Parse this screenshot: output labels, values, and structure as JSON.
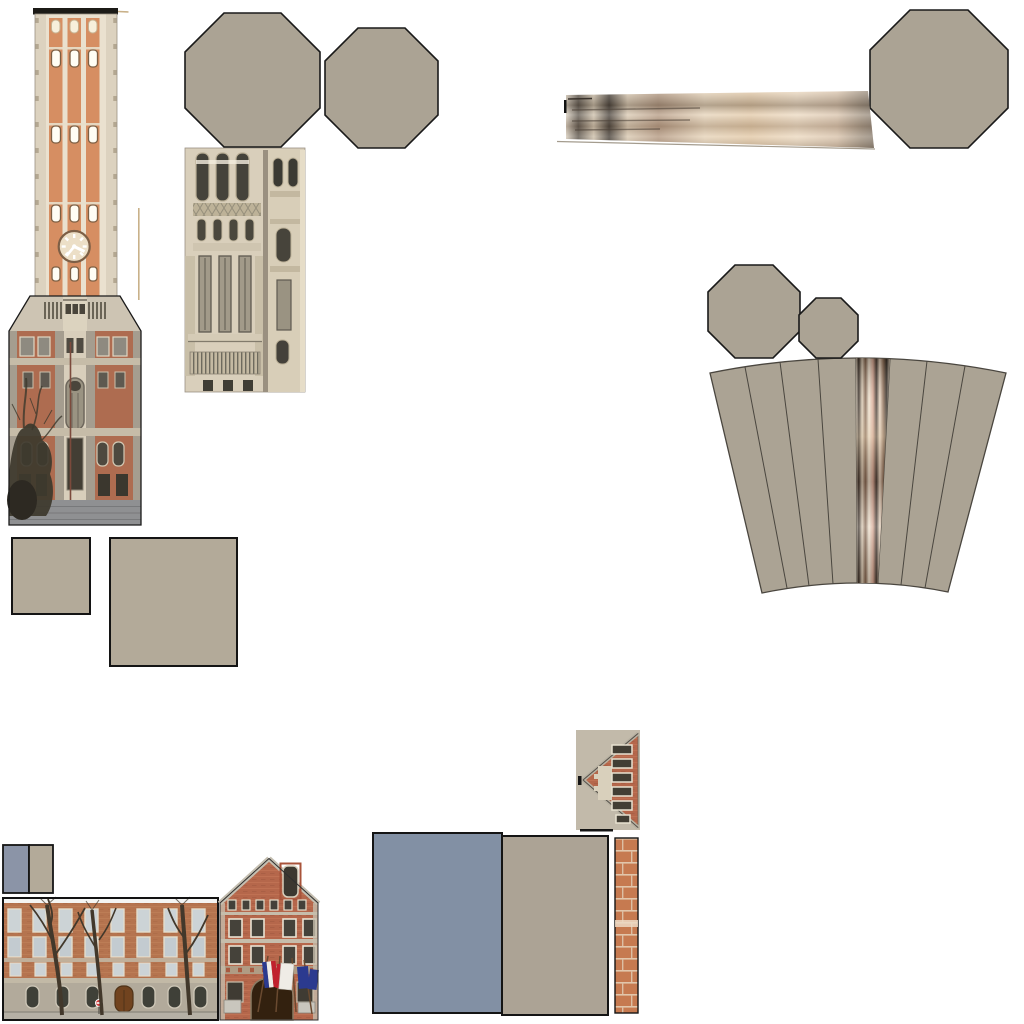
{
  "page": {
    "background": "#ffffff",
    "kind": "texture-atlas-sheet",
    "subject": "unwrapped photo textures and flat roof/wall color patches for 3D building models (belfry tower, school facades, octagonal roof caps, cone roof fan)"
  },
  "palette": {
    "outline": "#1a1a1a",
    "taupe": "#aba394",
    "taupe_light": "#c2baaa",
    "taupe_square": "#b3aa99",
    "taupe_rect": "#aca395",
    "slate_blue": "#8290a4",
    "slate_blue_small": "#8b94a7",
    "tower_cream": "#eae1cf",
    "tower_side_stone": "#dcd2bf",
    "tower_orange": "#d68e62",
    "tower_cap": "#1c1b17",
    "tan_line": "#c9b189",
    "trapezoid_stone": "#cdc4b3",
    "base_fill": "#b3a794",
    "base_brick": "#ae6c50",
    "base_stone_band": "#c6bca8",
    "base_cream_bay": "#d8cebb",
    "wall_gray": "#8f9092",
    "tree_dark": "#3d392d",
    "bush_dark": "#2d2922",
    "facade_beige": "#d9cfbb",
    "facade_window_dark": "#45433b",
    "facade_band": "#cfc5b0",
    "turret_body": "#d8ceb8",
    "fan_line": "#4a463f",
    "school_sky": "#f4f4f2",
    "school_ground": "#b2aa9b",
    "school_glass": "#ccd3d6",
    "school_frame": "#e3ddcc",
    "door_brown": "#71431f",
    "gable_trim": "#c6bdab",
    "roof_edge_gray": "#c4beb0",
    "entrance_dark": "#33210f",
    "flag_blue": "#2b3a8f",
    "flag_red": "#c0212e",
    "flag_white": "#efece6",
    "sidewalk": "#b5b0a5",
    "sign_red": "#d23b3b"
  },
  "pieces": {
    "belfry_tower": "belfry clock-tower photo texture",
    "octagon_left": "large octagonal roof panel",
    "octagon_right": "large octagonal roof panel",
    "octagon_top_right": "octagonal roof panel",
    "octagon_mid": "medium octagonal roof panel",
    "octagon_small": "small octagonal roof panel",
    "lantern_facade": "belfry lantern stone facade texture",
    "stretched_strip": "stretched blurred facade strip texture",
    "cone_fan": "unwrapped cone roof fan with radial panels and one photo panel",
    "square_small": "plain taupe square patch",
    "square_large": "plain taupe square patch",
    "swatch_pair": "small blue-gray and taupe swatch rectangle",
    "school_facade": "red-brick school facade photo with bare trees",
    "gabled_building": "gabled town-hall facade photo with flags",
    "gable_side": "rotated gable-end brick texture",
    "blue_wall_rect": "plain slate-blue wall rectangle",
    "taupe_wall_rect": "plain taupe wall rectangle",
    "brick_strip": "orange brick column strip texture"
  }
}
